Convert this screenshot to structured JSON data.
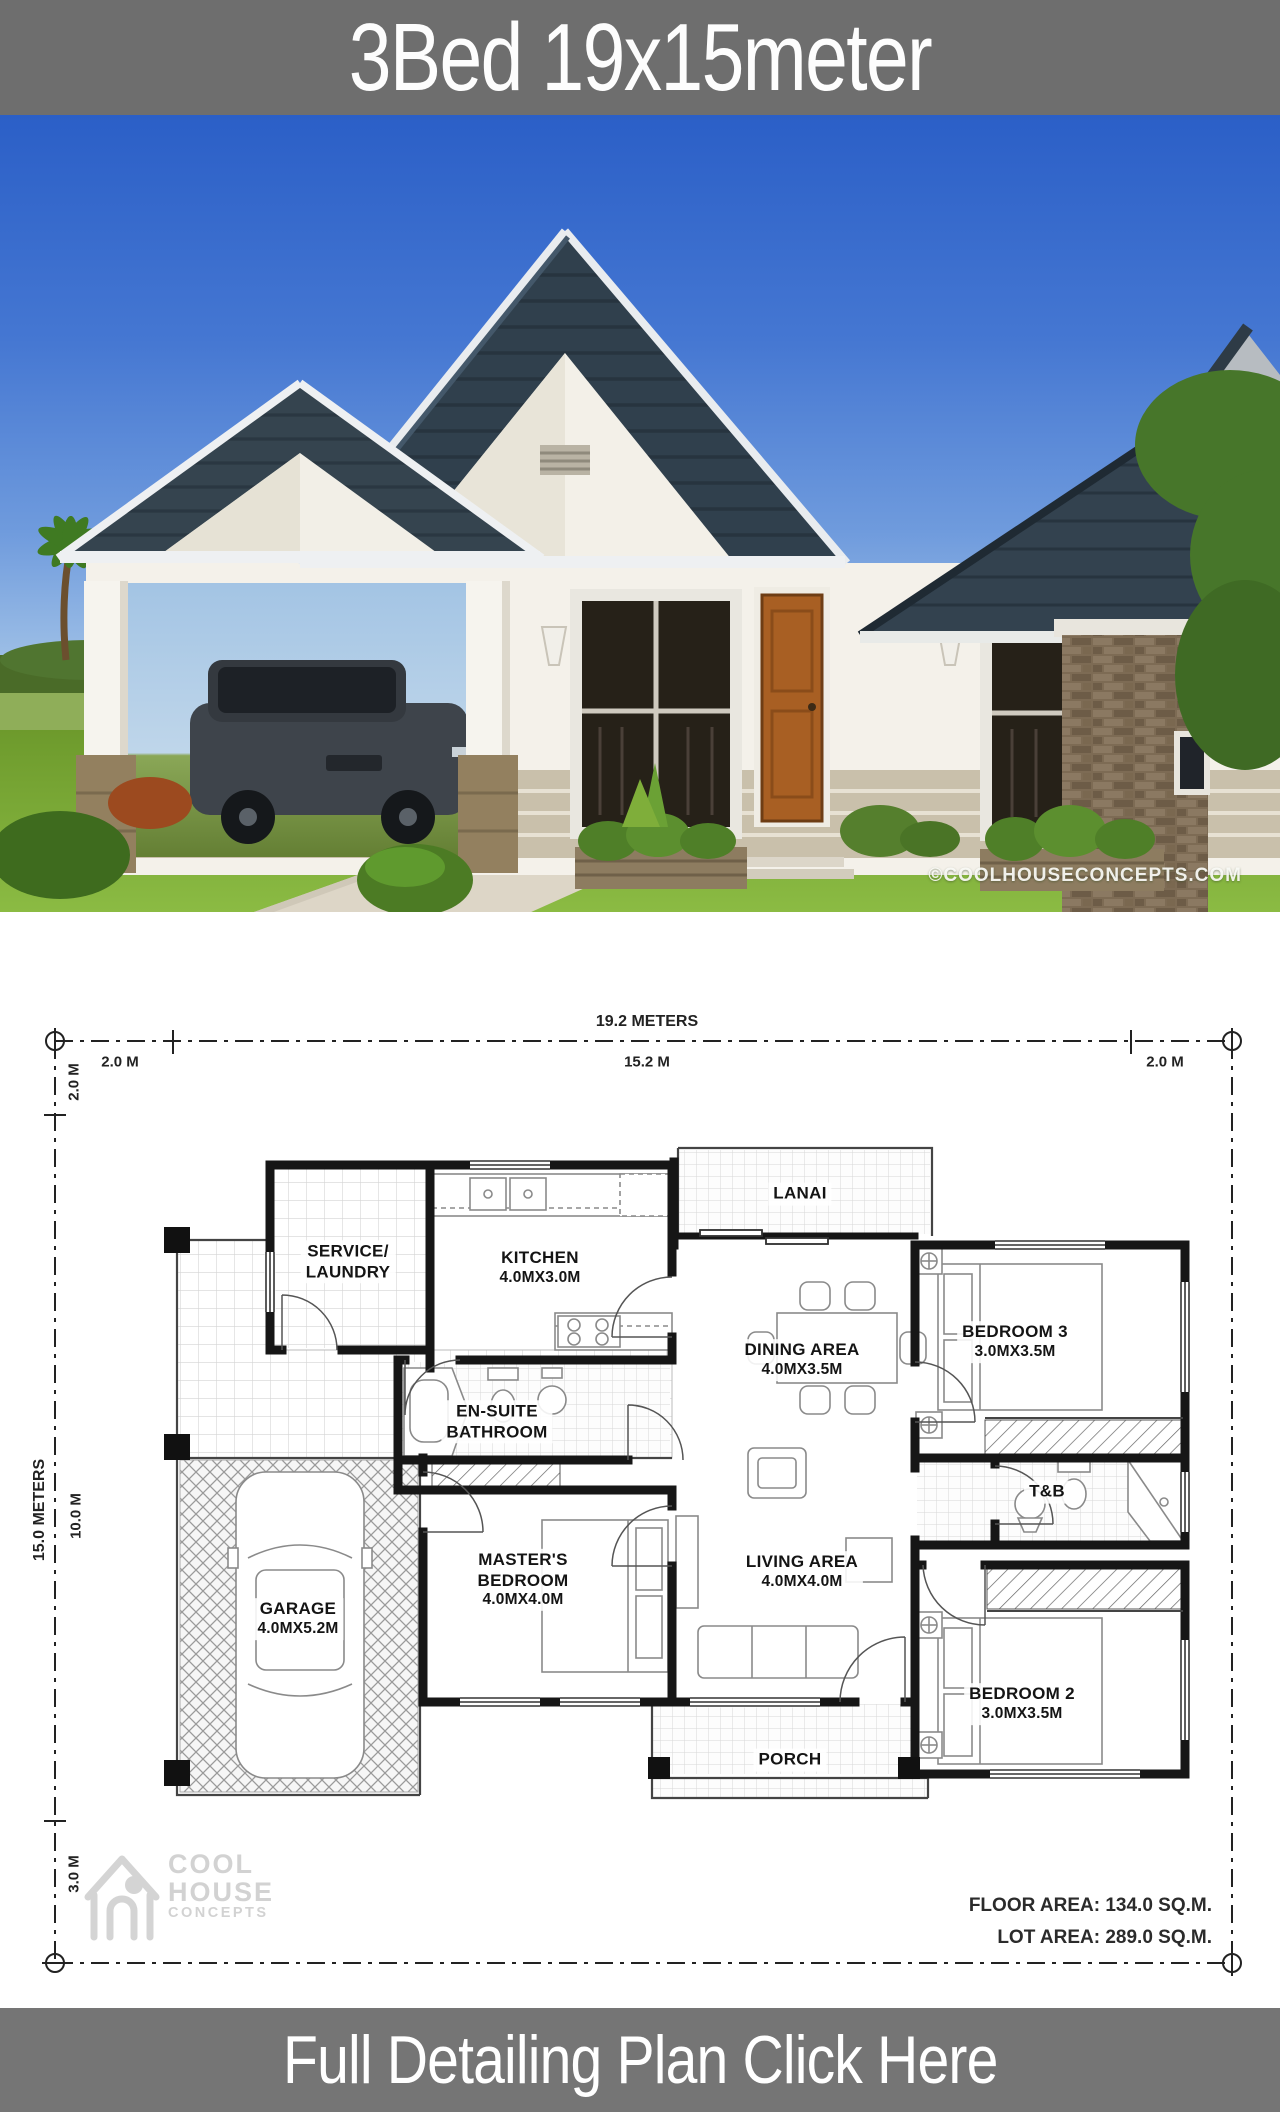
{
  "title_banner": {
    "text": "3Bed 19x15meter",
    "bg": "#6e6e6e",
    "fg": "#ffffff"
  },
  "photo": {
    "watermark": "©COOLHOUSECONCEPTS.COM"
  },
  "plan": {
    "dim_top": {
      "total": "19.2 METERS",
      "left": "2.0 M",
      "mid": "15.2 M",
      "right": "2.0 M"
    },
    "dim_left": {
      "total": "15.0 METERS",
      "top": "2.0 M",
      "mid": "10.0 M",
      "bottom": "3.0 M"
    },
    "rooms": {
      "service": {
        "name": "SERVICE/\nLAUNDRY"
      },
      "kitchen": {
        "name": "KITCHEN",
        "dims": "4.0MX3.0M"
      },
      "lanai": {
        "name": "LANAI"
      },
      "dining": {
        "name": "DINING AREA",
        "dims": "4.0MX3.5M"
      },
      "bedroom3": {
        "name": "BEDROOM 3",
        "dims": "3.0MX3.5M"
      },
      "ensuite": {
        "name": "EN-SUITE\nBATHROOM"
      },
      "tb": {
        "name": "T&B"
      },
      "garage": {
        "name": "GARAGE",
        "dims": "4.0MX5.2M"
      },
      "master": {
        "name": "MASTER'S\nBEDROOM",
        "dims": "4.0MX4.0M"
      },
      "living": {
        "name": "LIVING AREA",
        "dims": "4.0MX4.0M"
      },
      "bedroom2": {
        "name": "BEDROOM 2",
        "dims": "3.0MX3.5M"
      },
      "porch": {
        "name": "PORCH"
      }
    },
    "areas": {
      "floor": "FLOOR AREA: 134.0 SQ.M.",
      "lot": "LOT AREA: 289.0 SQ.M."
    },
    "logo": {
      "line1": "COOL",
      "line2": "HOUSE",
      "line3": "CONCEPTS"
    }
  },
  "cta_banner": {
    "text": "Full Detailing Plan Click Here",
    "bg": "#757575",
    "fg": "#ffffff"
  }
}
